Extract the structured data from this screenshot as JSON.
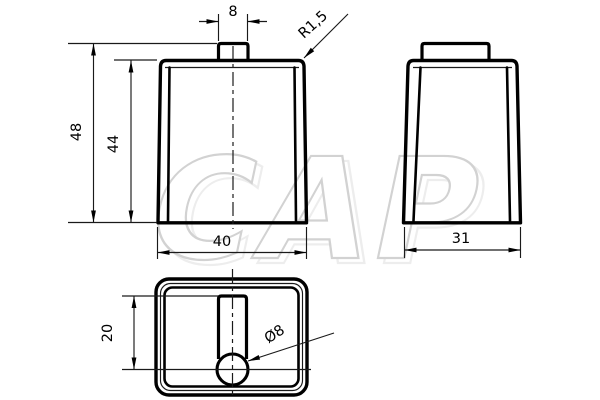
{
  "drawing": {
    "watermark_text": "CAP",
    "dimensions": {
      "tab_width": "8",
      "corner_radius": "R1,5",
      "overall_height": "48",
      "body_height": "44",
      "front_width": "40",
      "side_depth": "31",
      "slot_offset": "20",
      "hole_diameter": "Ø8"
    },
    "colors": {
      "line": "#000000",
      "watermark_outline": "#d2d2d2",
      "background": "#ffffff"
    }
  }
}
